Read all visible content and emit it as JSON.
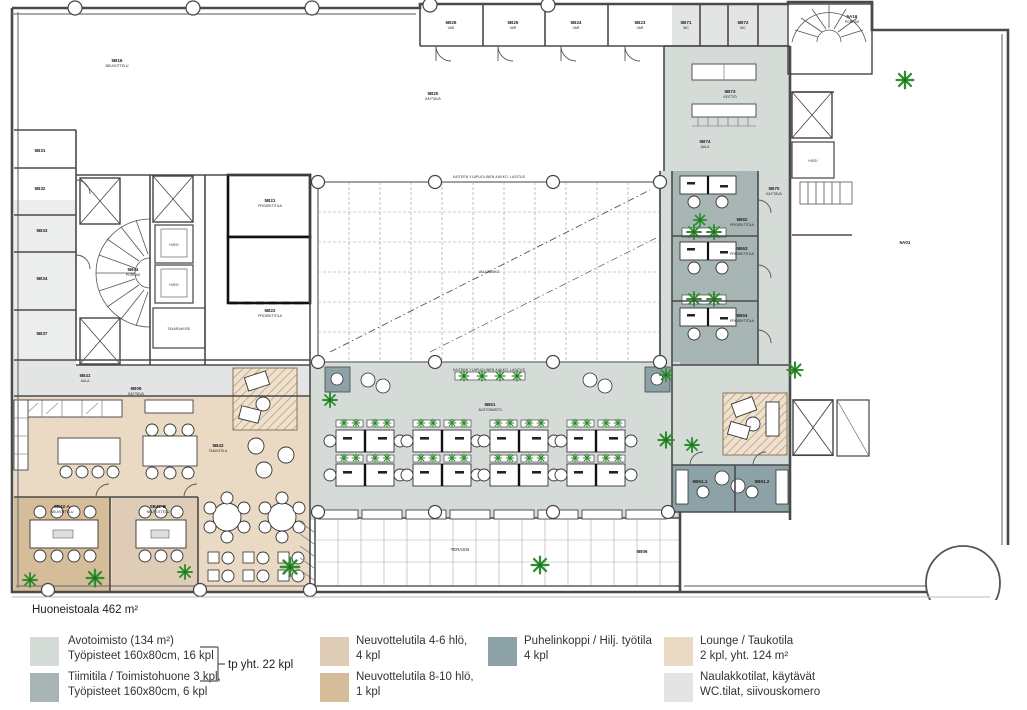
{
  "title": "Huoneistoala 462 m²",
  "colors": {
    "open_office": "#d5dcd8",
    "team_room": "#a7b6b4",
    "phone_booth": "#8da2a6",
    "meeting_4_6": "#dfccb6",
    "meeting_8_10": "#d6bd99",
    "lounge": "#ead9c3",
    "corridor": "#e3e4e4",
    "plant_green": "#2f8f2f",
    "wall": "#4a4a4a"
  },
  "legend": {
    "bracket_label": "tp yht. 22 kpl",
    "items": [
      {
        "color": "#d5dcd8",
        "line1": "Avotoimisto (134 m²)",
        "line2": "Työpisteet 160x80cm, 16 kpl"
      },
      {
        "color": "#a7b6b4",
        "line1": "Tiimitila / Toimistohuone 3 kpl,",
        "line2": "Työpisteet 160x80cm, 6 kpl"
      },
      {
        "color": "#dfccb6",
        "line1": "Neuvottelutila 4-6 hlö,",
        "line2": "4 kpl"
      },
      {
        "color": "#d6bd99",
        "line1": "Neuvottelutila 8-10 hlö,",
        "line2": "1 kpl"
      },
      {
        "color": "#8da2a6",
        "line1": "Puhelinkoppi / Hilj. työtila",
        "line2": "4 kpl"
      },
      {
        "color": "#ead9c3",
        "line1": "Lounge / Taukotila",
        "line2": "2 kpl, yht. 124 m²"
      },
      {
        "color": "#e3e4e4",
        "line1": "Naulakkotilat, käytävät",
        "line2": "WC.tilat, siivouskomero"
      }
    ]
  },
  "plan": {
    "rooms": {
      "b16": {
        "num": "5B16",
        "sub": "NEUVOTTELU"
      },
      "b20": {
        "num": "5B20",
        "sub": "KÄYTÄVÄ"
      },
      "b26": {
        "num": "5B26",
        "sub": "VAR"
      },
      "b25": {
        "num": "5B25",
        "sub": "VAR"
      },
      "b24": {
        "num": "5B24",
        "sub": "VAR"
      },
      "b23": {
        "num": "5B23",
        "sub": "VAR"
      },
      "b71": {
        "num": "5B71",
        "sub": "WC"
      },
      "b72": {
        "num": "5B72",
        "sub": "WC"
      },
      "b73": {
        "num": "5B73",
        "sub": "KEITTIÖ"
      },
      "b74": {
        "num": "5B74",
        "sub": "AULA"
      },
      "b70": {
        "num": "5B70",
        "sub": "KÄYTÄVÄ"
      },
      "b62": {
        "num": "5B62",
        "sub": "PROJEKTITILA"
      },
      "b63": {
        "num": "5B63",
        "sub": "PROJEKTITILA"
      },
      "b64": {
        "num": "5B64",
        "sub": "PROJEKTITILA"
      },
      "b61": {
        "num": "5B61",
        "sub": "AVOTOIMISTO"
      },
      "b611": {
        "num": "5B61.1",
        "sub": "PUH"
      },
      "b612": {
        "num": "5B61.2",
        "sub": "PUH"
      },
      "b43": {
        "num": "5B43",
        "sub": "TAUKOTILA"
      },
      "b09": {
        "num": "5B09",
        "sub": "KÄYTÄVÄ"
      },
      "b41": {
        "num": "5B41",
        "sub": "AULA"
      },
      "b42a": {
        "num": "5B42-A",
        "sub": "NEUVOTTELU"
      },
      "b42b": {
        "num": "5B42-B",
        "sub": "NEUVOTTELU"
      },
      "b21": {
        "num": "5B21",
        "sub": "PROJEKTITILA"
      },
      "b22": {
        "num": "5B22",
        "sub": "PROJEKTITILA"
      },
      "b04": {
        "num": "5B04",
        "sub": "PORRAS"
      },
      "b31": {
        "num": "5B31"
      },
      "b32": {
        "num": "5B32"
      },
      "b33": {
        "num": "5B33"
      },
      "b34": {
        "num": "5B34"
      },
      "b37": {
        "num": "5B37"
      },
      "a01": {
        "num": "5A01"
      },
      "a16": {
        "num": "5A16",
        "sub": "PORRAS"
      },
      "b06": {
        "num": "5B06"
      }
    },
    "annotations": {
      "terassi": "TERASSI",
      "valoaukko": "VALOAUKKO",
      "aukko_top": "KAITEEN YLÄPUOLINEN AUKKO, LASITUS",
      "aukko_bottom": "KAITEEN YLÄPUOLINEN AUKKO, LASITUS",
      "hissi1": "HISSI",
      "hissi2": "HISSI",
      "hissi3": "HISSI",
      "tavarahissi": "TAVARAHISSI"
    }
  }
}
